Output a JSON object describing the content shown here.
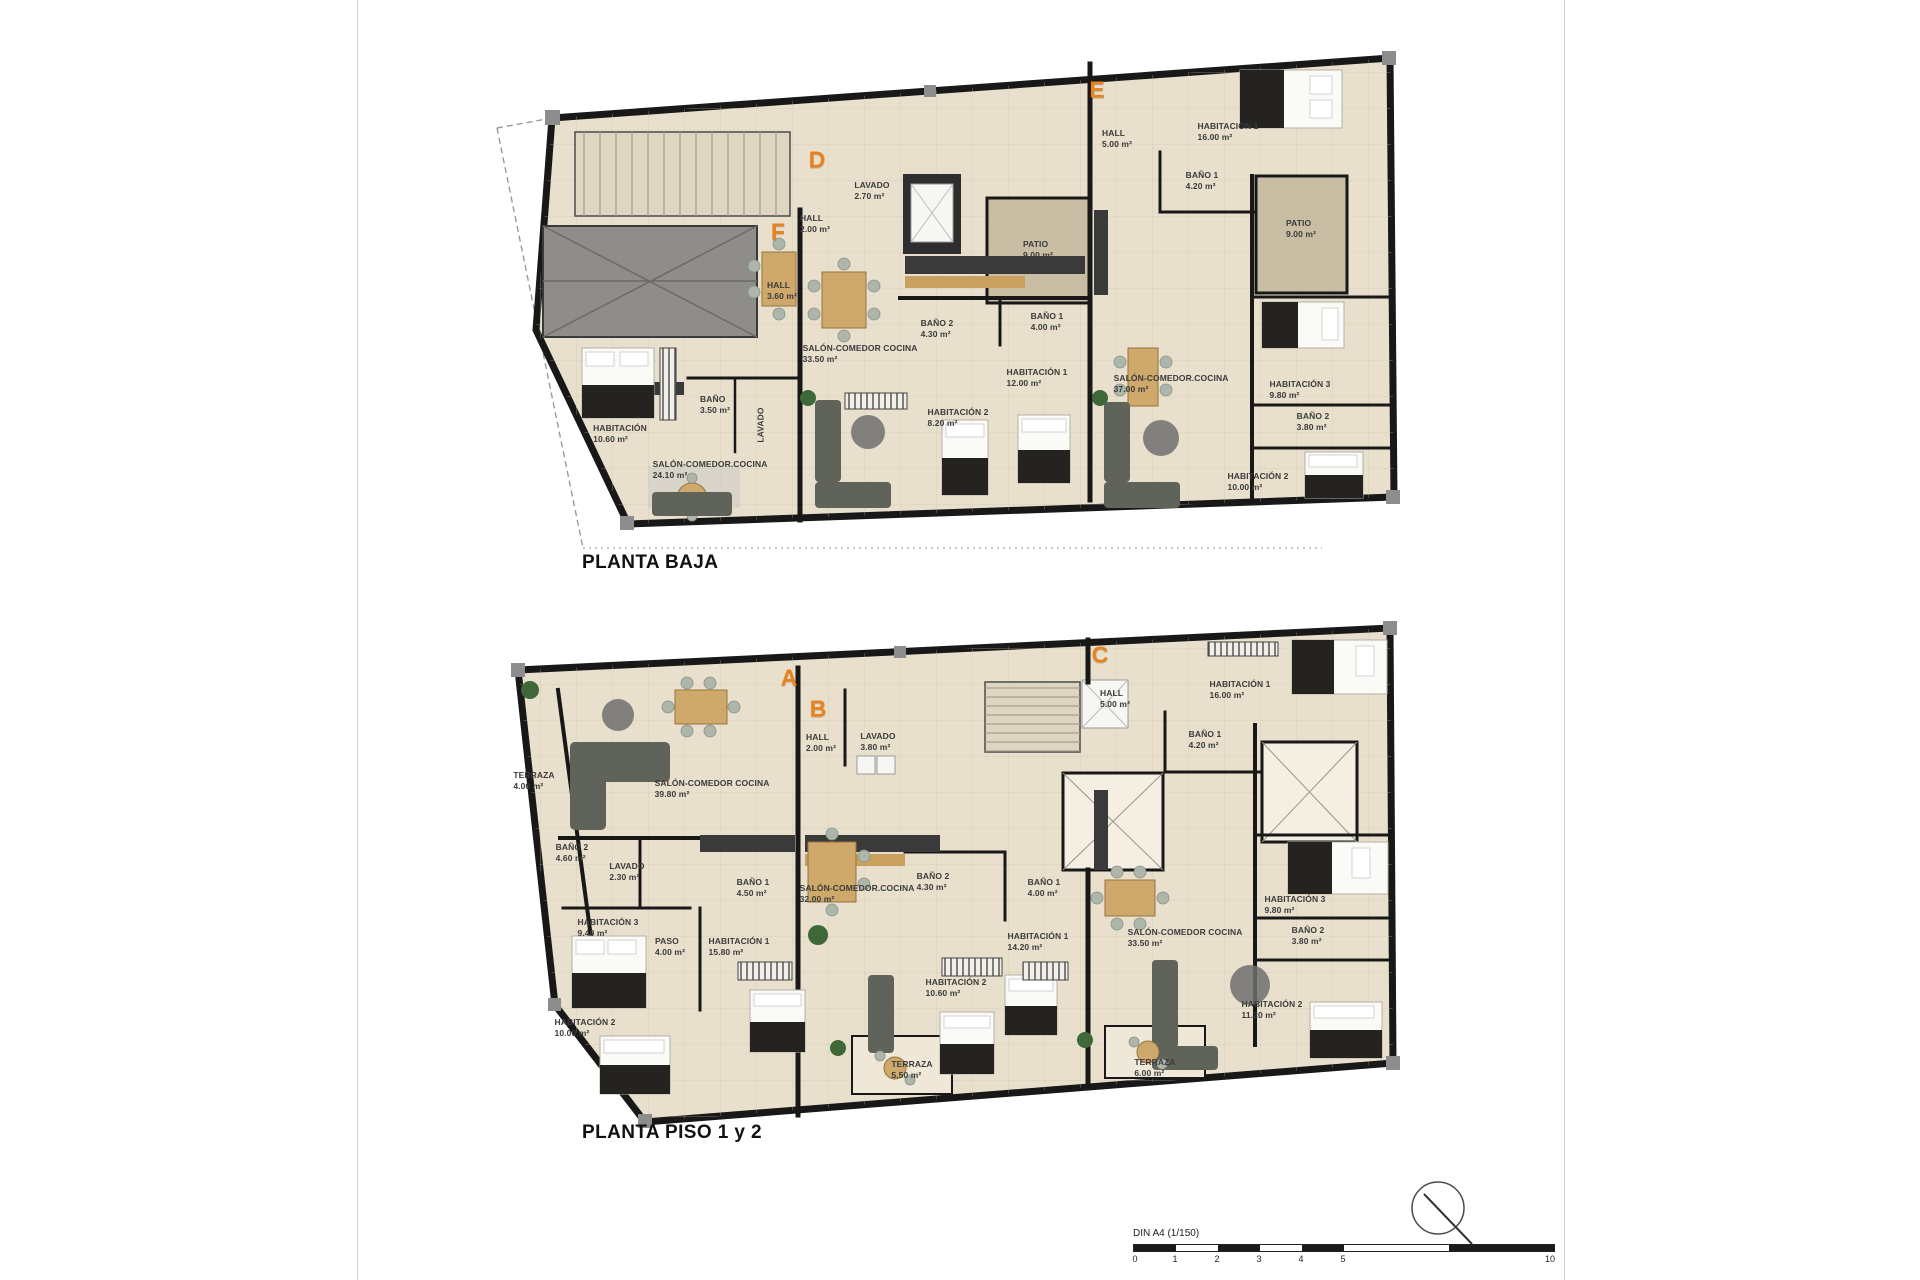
{
  "sheet": {
    "colors": {
      "accent_letter": "#e8821e",
      "wall": "#181818",
      "floor": "#e8e0cd",
      "patio": "#c9bda4"
    },
    "scale": {
      "label": "DIN A4 (1/150)",
      "ticks": [
        "0",
        "1",
        "2",
        "3",
        "4",
        "5",
        "10"
      ]
    },
    "plans": [
      {
        "title": "PLANTA BAJA",
        "units": [
          {
            "id": "D",
            "x": 817,
            "y": 160
          },
          {
            "id": "E",
            "x": 1097,
            "y": 90
          },
          {
            "id": "F",
            "x": 778,
            "y": 232
          }
        ],
        "rooms": [
          {
            "label": "LAVADO",
            "area": "2.70 m²",
            "x": 872,
            "y": 191
          },
          {
            "label": "HALL",
            "area": "2.00 m²",
            "x": 815,
            "y": 224
          },
          {
            "label": "HALL",
            "area": "3.60 m²",
            "x": 782,
            "y": 291
          },
          {
            "label": "BAÑO",
            "area": "3.50 m²",
            "x": 715,
            "y": 405
          },
          {
            "label": "LAVADO",
            "area": "",
            "x": 761,
            "y": 425,
            "rot": true
          },
          {
            "label": "HABITACIÓN",
            "area": "10.60 m²",
            "x": 620,
            "y": 434
          },
          {
            "label": "SALÓN-COMEDOR.COCINA",
            "area": "24.10 m²",
            "x": 710,
            "y": 470
          },
          {
            "label": "SALÓN-COMEDOR COCINA",
            "area": "33.50 m²",
            "x": 860,
            "y": 354
          },
          {
            "label": "BAÑO 2",
            "area": "4.30 m²",
            "x": 937,
            "y": 329
          },
          {
            "label": "BAÑO 1",
            "area": "4.00 m²",
            "x": 1047,
            "y": 322
          },
          {
            "label": "HABITACIÓN 1",
            "area": "12.00 m²",
            "x": 1037,
            "y": 378
          },
          {
            "label": "HABITACIÓN 2",
            "area": "8.20 m²",
            "x": 958,
            "y": 418
          },
          {
            "label": "PATIO",
            "area": "9.00 m²",
            "x": 1038,
            "y": 250
          },
          {
            "label": "HALL",
            "area": "5.00 m²",
            "x": 1117,
            "y": 139
          },
          {
            "label": "HABITACIÓN 1",
            "area": "16.00 m²",
            "x": 1228,
            "y": 132
          },
          {
            "label": "BAÑO 1",
            "area": "4.20 m²",
            "x": 1202,
            "y": 181
          },
          {
            "label": "PATIO",
            "area": "9.00 m²",
            "x": 1301,
            "y": 229
          },
          {
            "label": "SALÓN-COMEDOR.COCINA",
            "area": "37.00 m²",
            "x": 1171,
            "y": 384
          },
          {
            "label": "HABITACIÓN 3",
            "area": "9.80 m²",
            "x": 1300,
            "y": 390
          },
          {
            "label": "BAÑO 2",
            "area": "3.80 m²",
            "x": 1313,
            "y": 422
          },
          {
            "label": "HABITACIÓN 2",
            "area": "10.00 m²",
            "x": 1258,
            "y": 482
          }
        ]
      },
      {
        "title": "PLANTA PISO 1 y 2",
        "units": [
          {
            "id": "A",
            "x": 789,
            "y": 678
          },
          {
            "id": "B",
            "x": 818,
            "y": 709
          },
          {
            "id": "C",
            "x": 1100,
            "y": 655
          }
        ],
        "rooms": [
          {
            "label": "TERRAZA",
            "area": "4.00 m²",
            "x": 534,
            "y": 781
          },
          {
            "label": "SALÓN-COMEDOR COCINA",
            "area": "39.80 m²",
            "x": 712,
            "y": 789
          },
          {
            "label": "HALL",
            "area": "2.00 m²",
            "x": 821,
            "y": 743
          },
          {
            "label": "LAVADO",
            "area": "3.80 m²",
            "x": 878,
            "y": 742
          },
          {
            "label": "BAÑO 2",
            "area": "4.60 m²",
            "x": 572,
            "y": 853
          },
          {
            "label": "LAVADO",
            "area": "2.30 m²",
            "x": 627,
            "y": 872
          },
          {
            "label": "BAÑO 1",
            "area": "4.50 m²",
            "x": 753,
            "y": 888
          },
          {
            "label": "HABITACIÓN 3",
            "area": "9.40 m²",
            "x": 608,
            "y": 928
          },
          {
            "label": "PASO",
            "area": "4.00 m²",
            "x": 670,
            "y": 947
          },
          {
            "label": "HABITACIÓN 1",
            "area": "15.80 m²",
            "x": 739,
            "y": 947
          },
          {
            "label": "HABITACIÓN 2",
            "area": "10.00 m²",
            "x": 585,
            "y": 1028
          },
          {
            "label": "SALÓN-COMEDOR.COCINA",
            "area": "32.00 m²",
            "x": 857,
            "y": 894
          },
          {
            "label": "BAÑO 2",
            "area": "4.30 m²",
            "x": 933,
            "y": 882
          },
          {
            "label": "BAÑO 1",
            "area": "4.00 m²",
            "x": 1044,
            "y": 888
          },
          {
            "label": "HABITACIÓN 1",
            "area": "14.20 m²",
            "x": 1038,
            "y": 942
          },
          {
            "label": "HABITACIÓN 2",
            "area": "10.60 m²",
            "x": 956,
            "y": 988
          },
          {
            "label": "TERRAZA",
            "area": "5.50 m²",
            "x": 912,
            "y": 1070
          },
          {
            "label": "HALL",
            "area": "5.00 m²",
            "x": 1115,
            "y": 699
          },
          {
            "label": "HABITACIÓN 1",
            "area": "16.00 m²",
            "x": 1240,
            "y": 690
          },
          {
            "label": "BAÑO 1",
            "area": "4.20 m²",
            "x": 1205,
            "y": 740
          },
          {
            "label": "SALÓN-COMEDOR COCINA",
            "area": "33.50 m²",
            "x": 1185,
            "y": 938
          },
          {
            "label": "HABITACIÓN 3",
            "area": "9.80 m²",
            "x": 1295,
            "y": 905
          },
          {
            "label": "BAÑO 2",
            "area": "3.80 m²",
            "x": 1308,
            "y": 936
          },
          {
            "label": "HABITACIÓN 2",
            "area": "11.20 m²",
            "x": 1272,
            "y": 1010
          },
          {
            "label": "TERRAZA",
            "area": "6.00 m²",
            "x": 1155,
            "y": 1068
          }
        ]
      }
    ]
  }
}
